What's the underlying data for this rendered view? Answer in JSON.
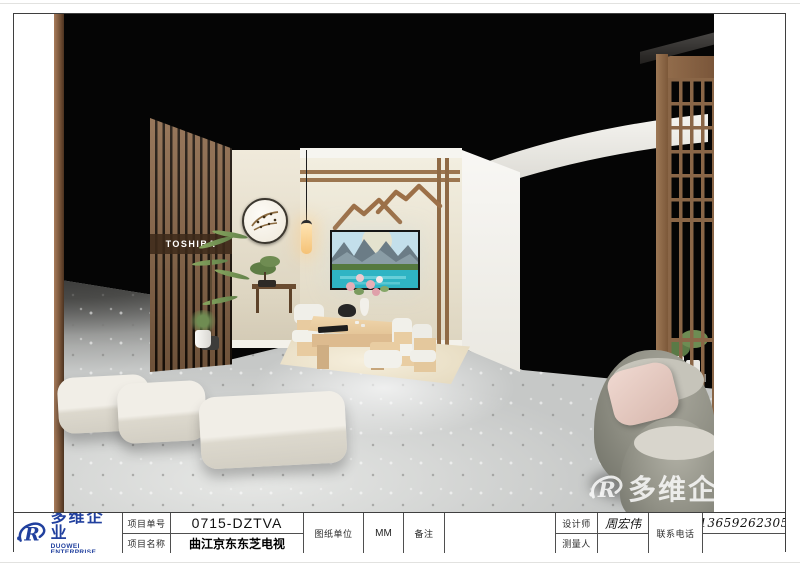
{
  "logo": {
    "name_cn": "多维企业",
    "name_en": "DUOWEI ENTERPRISE",
    "icon_letter": "R"
  },
  "title_block": {
    "project_no_label": "项目单号",
    "project_no": "0715-DZTVA",
    "project_name_label": "项目名称",
    "project_name": "曲江京东东芝电视",
    "unit_label": "图纸单位",
    "unit_value": "MM",
    "remarks_label": "备注",
    "remarks_value": "",
    "designer_label": "设计师",
    "designer_value": "周宏伟",
    "surveyor_label": "测量人",
    "surveyor_value": "",
    "phone_label": "联系电话",
    "phone_value": "13659262305"
  },
  "scene": {
    "brand_sign": "TOSHIBA",
    "watermark_text": "多维企",
    "colors": {
      "accent_blue": "#21409e",
      "wood_brown": "#8a6647",
      "wall_beige": "#e8e1cf",
      "floor_gray": "#c6c8c7",
      "backdrop_black": "#000000",
      "sign_white": "#ffffff",
      "armchair_olive": "#8c8c81",
      "lake_teal": "#2fb4c4"
    }
  }
}
